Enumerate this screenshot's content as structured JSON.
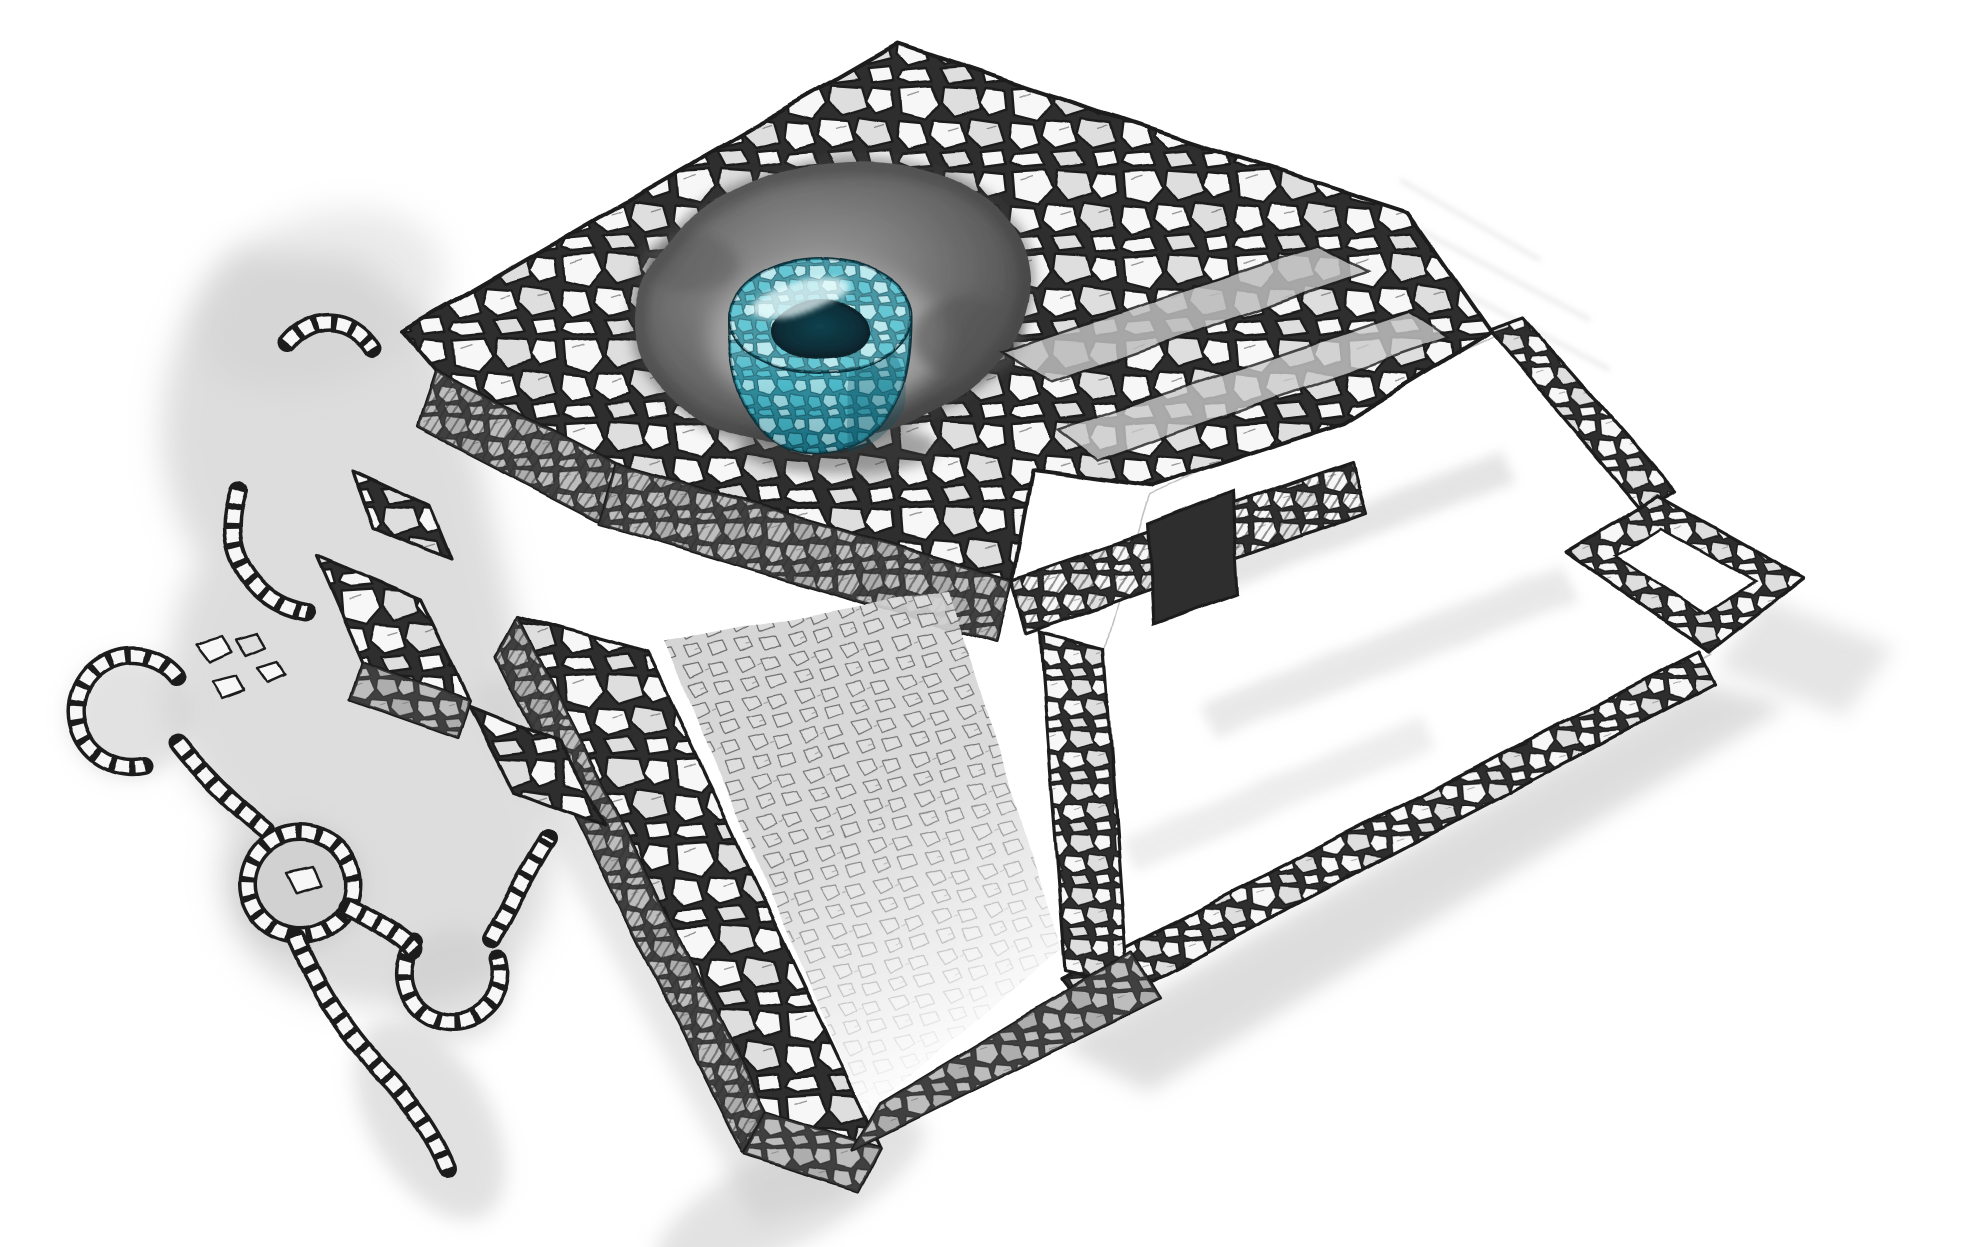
{
  "scene": {
    "title": "Hand-drawn isometric illustration of a ruined cobblestone building",
    "description": "Pencil-and-ink ruins with gray wash shadows. A round stone well highlighted in teal sits inside a dark sunken basin on the upper platform. A square annex and long perimeter wall extend to the right; collapsed wall fragments, stone circles and rubble chains lie to the lower left.",
    "background": "#ffffff"
  },
  "palette": {
    "paper": "#ffffff",
    "ink": "#1f1f1f",
    "stoneFill": "#f7f7f7",
    "stoneShade": "#dedede",
    "joints": "#2e2e2e",
    "washLight": "#c4c4c4",
    "washMid": "#9e9e9e",
    "faceShade": "#5e5e5e",
    "craterEdge": "#474747",
    "craterMid": "#7e7e7e",
    "craterHalo": "#ababab",
    "doorway": "#2f2f2f",
    "rampStone": "#dcdcdc",
    "rampStroke": "#4f4f4f",
    "tealPale": "#d8f2f4",
    "tealLight": "#8fdce5",
    "tealMid": "#49b8c8",
    "tealDeep": "#176a7c",
    "tealOutline": "#0a303a",
    "holeDark": "#0a2d37",
    "wellShadow": "#3c3c3c"
  },
  "features": [
    "upper platform with sunken basin",
    "teal stone well",
    "cobblestone walls",
    "right courtyard floor",
    "square annex enclosure",
    "southeast perimeter wall",
    "entrance ramp",
    "doorway opening",
    "collapsed wall fragments",
    "stone circle with center stone",
    "horseshoe-shaped rubble arcs",
    "rubble chains",
    "gray ground-shadow washes"
  ]
}
